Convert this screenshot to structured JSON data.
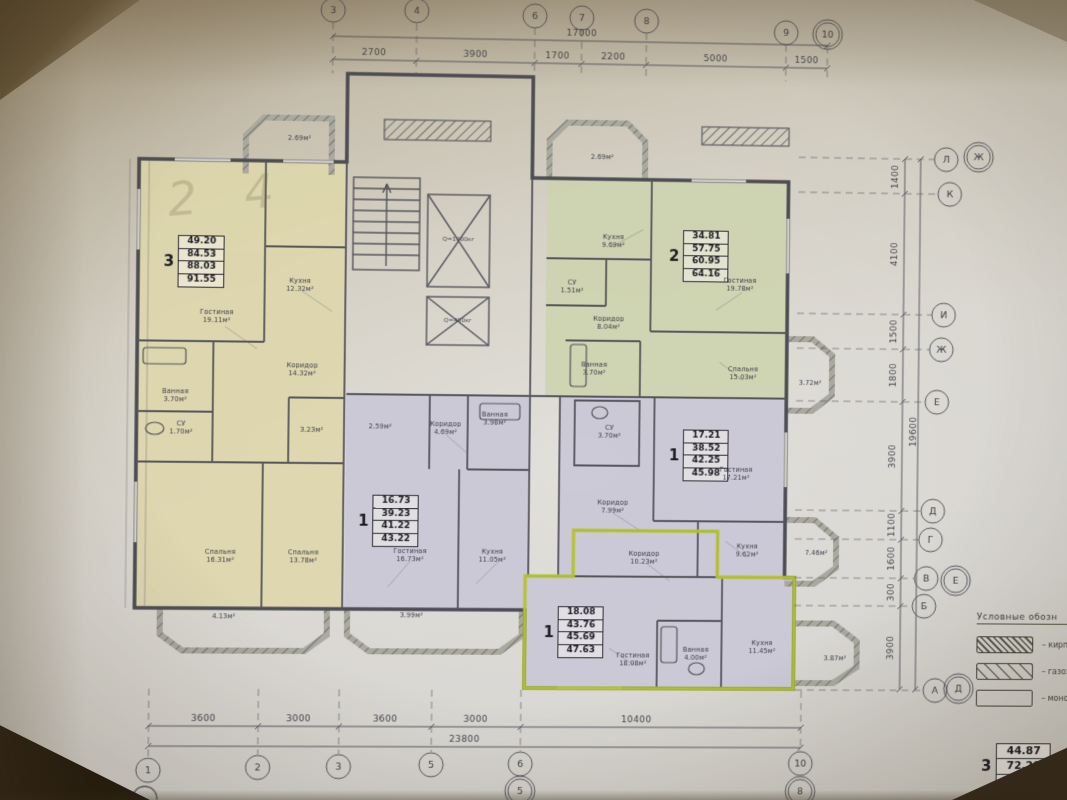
{
  "grid": {
    "top_bubbles": [
      "3",
      "4",
      "6",
      "7",
      "8",
      "9",
      "10"
    ],
    "top_dims": [
      "2700",
      "3900",
      "1700",
      "2200",
      "5000",
      "1500"
    ],
    "top_overall": "17000",
    "bottom_bubbles": [
      "1",
      "2",
      "3",
      "5",
      "6",
      "10"
    ],
    "bottom_sub_bubbles": [
      "5",
      "8"
    ],
    "bottom_dims": [
      "3600",
      "3000",
      "3600",
      "3000",
      "10400"
    ],
    "bottom_overall": "23800",
    "right_bubbles": [
      "Л",
      "Ж",
      "К",
      "И",
      "Ж",
      "Е",
      "Д",
      "Г",
      "В",
      "Е",
      "Б",
      "А",
      "Д"
    ],
    "right_dims": [
      "1400",
      "4100",
      "1500",
      "1800",
      "3900",
      "1100",
      "1600",
      "300",
      "3900"
    ],
    "right_overall": "19600"
  },
  "apartments": [
    {
      "number": "3",
      "rows": [
        "49.20",
        "84.53",
        "88.03",
        "91.55"
      ]
    },
    {
      "number": "2",
      "rows": [
        "34.81",
        "57.75",
        "60.95",
        "64.16"
      ]
    },
    {
      "number": "1",
      "rows": [
        "16.73",
        "39.23",
        "41.22",
        "43.22"
      ]
    },
    {
      "number": "1",
      "rows": [
        "17.21",
        "38.52",
        "42.25",
        "45.98"
      ]
    },
    {
      "number": "1",
      "rows": [
        "18.08",
        "43.76",
        "45.69",
        "47.63"
      ]
    }
  ],
  "rooms": [
    {
      "n": "Гостиная",
      "a": "19.11м²"
    },
    {
      "n": "Кухня",
      "a": "12.32м²"
    },
    {
      "n": "Коридор",
      "a": "14.32м²"
    },
    {
      "n": "Ванная",
      "a": "3.70м²"
    },
    {
      "n": "СУ",
      "a": "1.70м²"
    },
    {
      "n": "",
      "a": "3.23м²"
    },
    {
      "n": "Спальня",
      "a": "16.31м²"
    },
    {
      "n": "Спальня",
      "a": "13.78м²"
    },
    {
      "n": "",
      "a": "2.59м²"
    },
    {
      "n": "Кухня",
      "a": "9.69м²"
    },
    {
      "n": "СУ",
      "a": "1.51м²"
    },
    {
      "n": "Коридор",
      "a": "8.04м²"
    },
    {
      "n": "Гостиная",
      "a": "19.78м²"
    },
    {
      "n": "Ванная",
      "a": "3.70м²"
    },
    {
      "n": "Спальня",
      "a": "15.03м²"
    },
    {
      "n": "Коридор",
      "a": "4.69м²"
    },
    {
      "n": "Ванная",
      "a": "3.98м²"
    },
    {
      "n": "Гостиная",
      "a": "16.73м²"
    },
    {
      "n": "Кухня",
      "a": "11.05м²"
    },
    {
      "n": "СУ",
      "a": "3.70м²"
    },
    {
      "n": "Гостиная",
      "a": "17.21м²"
    },
    {
      "n": "Коридор",
      "a": "7.99м²"
    },
    {
      "n": "Кухня",
      "a": "9.62м²"
    },
    {
      "n": "Коридор",
      "a": "10.23м²"
    },
    {
      "n": "Гостиная",
      "a": "18.08м²"
    },
    {
      "n": "Ванная",
      "a": "4.00м²"
    },
    {
      "n": "Кухня",
      "a": "11.45м²"
    },
    {
      "n": "",
      "a": "2.69м²"
    },
    {
      "n": "",
      "a": "2.69м²"
    },
    {
      "n": "",
      "a": "3.72м²"
    },
    {
      "n": "",
      "a": "7.46м²"
    },
    {
      "n": "",
      "a": "3.87м²"
    },
    {
      "n": "",
      "a": "4.13м²"
    },
    {
      "n": "",
      "a": "3.99м²"
    }
  ],
  "elevators": {
    "large": "Q=1000кг",
    "small": "Q=400кг"
  },
  "legend": {
    "title": "Условные обозн",
    "items": [
      {
        "label": "– кирп"
      },
      {
        "label": "– газоз"
      },
      {
        "label": "– монол"
      }
    ]
  },
  "mini_table": {
    "number": "3",
    "rows": [
      "44.87",
      "72.29",
      "73.95"
    ]
  },
  "pencil_note": "2 4",
  "colors": {
    "apartment_yellow": "#ded7ab",
    "apartment_green": "#cdd3ae",
    "apartment_lavender": "#c9c7d7",
    "highlight_green": "#b3c430",
    "line": "#4f4f58",
    "paper": "#d4d1ca"
  }
}
